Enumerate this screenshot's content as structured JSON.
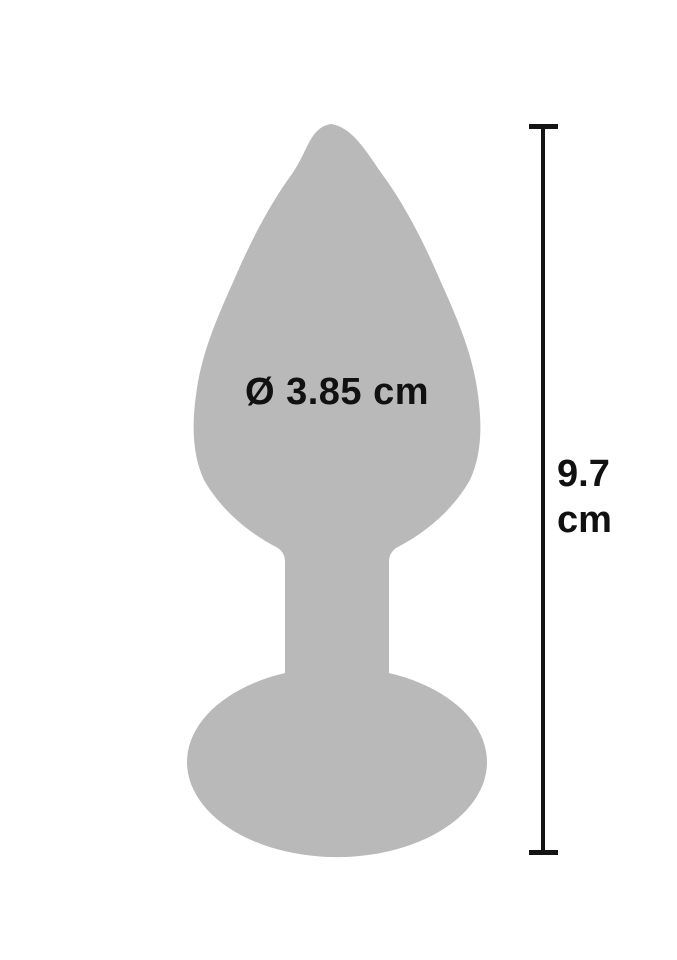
{
  "measurements": {
    "diameter": {
      "label": "Ø 3.85 cm",
      "symbol": "Ø",
      "value": "3.85",
      "unit": "cm"
    },
    "height": {
      "value": "9.7",
      "unit": "cm"
    }
  },
  "colors": {
    "silhouette": "#b9b9b9",
    "ink": "#141414",
    "background": "#ffffff"
  }
}
